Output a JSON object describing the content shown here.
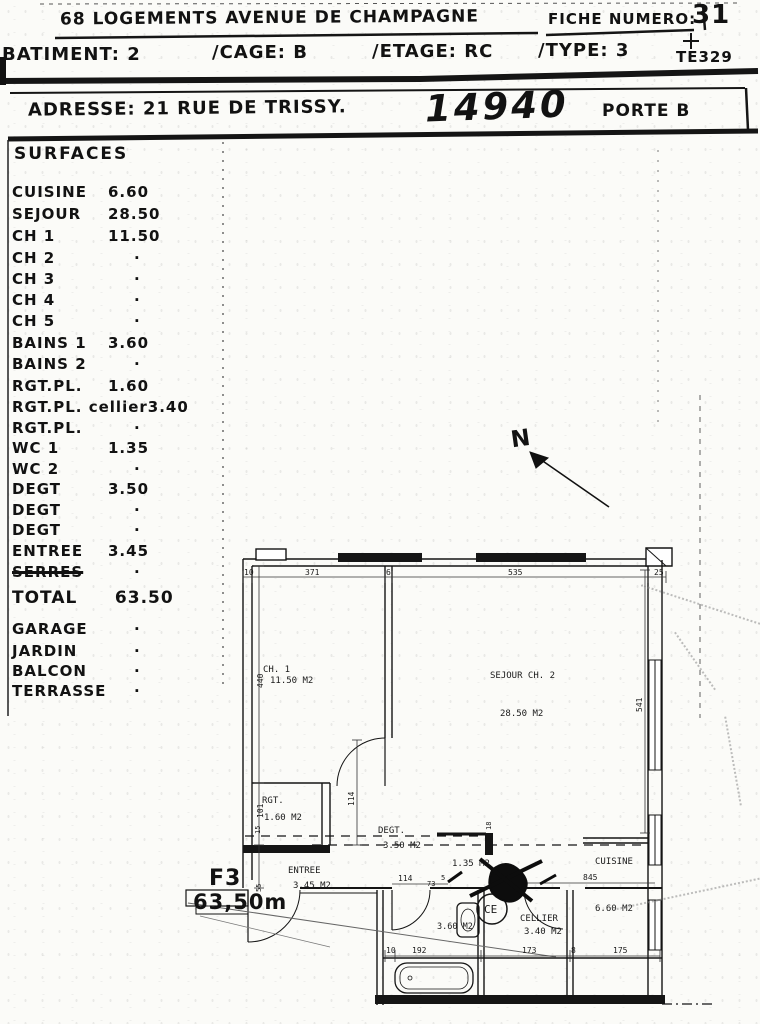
{
  "header": {
    "title": "68 LOGEMENTS AVENUE DE CHAMPAGNE",
    "fiche_label": "FICHE NUMERO:",
    "fiche_number": "31",
    "batiment": "BATIMENT: 2",
    "cage": "/CAGE: B",
    "etage": "/ETAGE: RC",
    "type": "/TYPE: 3",
    "ref_code": "TE329",
    "adresse": "ADRESSE: 21 RUE DE TRISSY.",
    "postal_stamp": "14940",
    "porte": "PORTE B"
  },
  "surfaces": {
    "title": "SURFACES",
    "rows": [
      {
        "label": "CUISINE",
        "value": "6.60"
      },
      {
        "label": "SEJOUR",
        "value": "28.50"
      },
      {
        "label": "CH 1",
        "value": "11.50"
      },
      {
        "label": "CH 2",
        "value": "·"
      },
      {
        "label": "CH 3",
        "value": "·"
      },
      {
        "label": "CH 4",
        "value": "·"
      },
      {
        "label": "CH 5",
        "value": "·"
      },
      {
        "label": "BAINS 1",
        "value": "3.60"
      },
      {
        "label": "BAINS 2",
        "value": "·"
      },
      {
        "label": "RGT.PL.",
        "value": "1.60"
      },
      {
        "label": "RGT.PL. cellier",
        "value": "3.40"
      },
      {
        "label": "RGT.PL.",
        "value": "·"
      },
      {
        "label": "WC 1",
        "value": "1.35"
      },
      {
        "label": "WC 2",
        "value": "·"
      },
      {
        "label": "DEGT",
        "value": "3.50"
      },
      {
        "label": "DEGT",
        "value": "·"
      },
      {
        "label": "DEGT",
        "value": "·"
      },
      {
        "label": "ENTREE",
        "value": "3.45"
      },
      {
        "label": "SERRES",
        "value": "·"
      }
    ],
    "total_label": "TOTAL",
    "total_value": "63.50",
    "extras": [
      {
        "label": "GARAGE",
        "value": "·"
      },
      {
        "label": "JARDIN",
        "value": "·"
      },
      {
        "label": "BALCON",
        "value": "·"
      },
      {
        "label": "TERRASSE",
        "value": "·"
      }
    ]
  },
  "plan": {
    "north": "N",
    "type_label": "F3",
    "area_label": "63,50m",
    "rooms": {
      "ch1_name": "CH. 1",
      "ch1_area": "11.50 M2",
      "sejour_name": "SEJOUR CH. 2",
      "sejour_area": "28.50 M2",
      "rgt_name": "RGT.",
      "rgt_area": "1.60 M2",
      "degt_name": "DEGT.",
      "degt_area": "3.50 M2",
      "entree_name": "ENTREE",
      "entree_area": "3.45 M2",
      "wc_area": "1.35 M2",
      "cuisine_name": "CUISINE",
      "cuisine_area": "6.60 M2",
      "cellier_name": "CELLIER",
      "cellier_area": "3.40 M2",
      "ce_label": "CE"
    },
    "dims": {
      "top": [
        "10",
        "371",
        "6",
        "535",
        "25"
      ],
      "left": [
        "440",
        "101",
        "15",
        "55"
      ],
      "right": [
        "541"
      ],
      "mid": [
        "114",
        "114",
        "73",
        "5",
        "18",
        "845"
      ],
      "bottom": [
        "10",
        "192",
        "173",
        "8",
        "175"
      ]
    }
  }
}
